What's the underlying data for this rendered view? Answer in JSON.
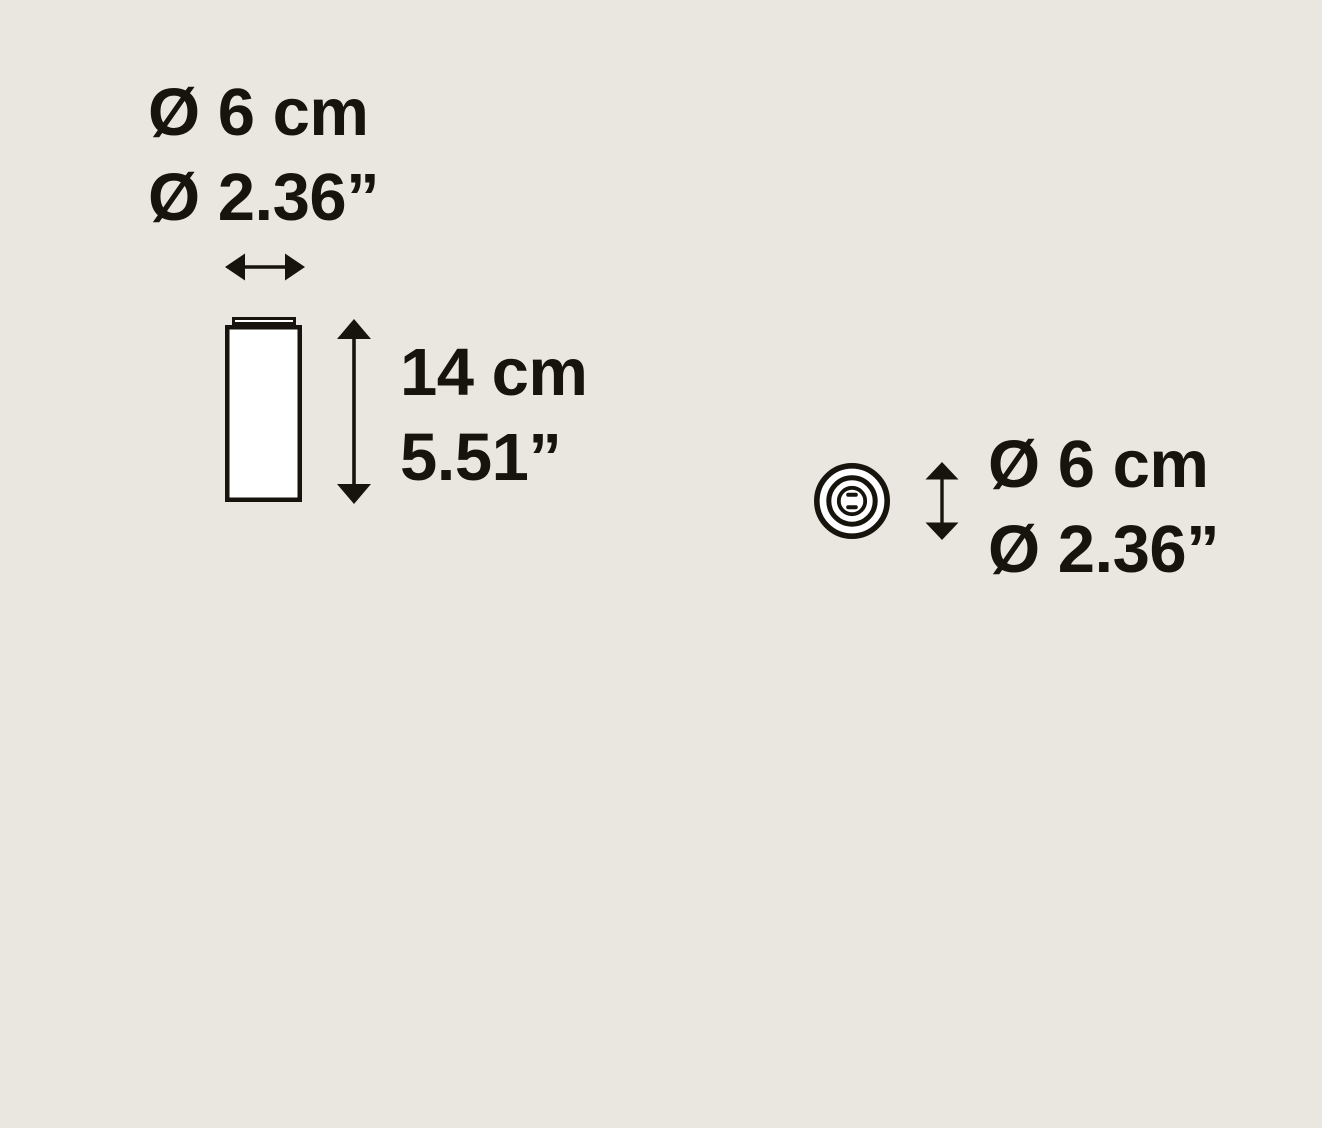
{
  "canvas": {
    "background_color": "#eae7e0",
    "ink_color": "#17130d",
    "shape_fill_color": "#ffffff"
  },
  "side_view": {
    "figure": "cylinder-side-view",
    "width_label": {
      "line1": "Ø 6 cm",
      "line2": "Ø 2.36”"
    },
    "height_label": {
      "line1": "14 cm",
      "line2": "5.51”"
    }
  },
  "top_view": {
    "figure": "cylinder-top-view",
    "diameter_label": {
      "line1": "Ø 6 cm",
      "line2": "Ø 2.36”"
    }
  },
  "icons": {
    "width_arrow": "horizontal-double-arrow",
    "height_arrow": "vertical-double-arrow",
    "diameter_arrow": "vertical-double-arrow"
  }
}
